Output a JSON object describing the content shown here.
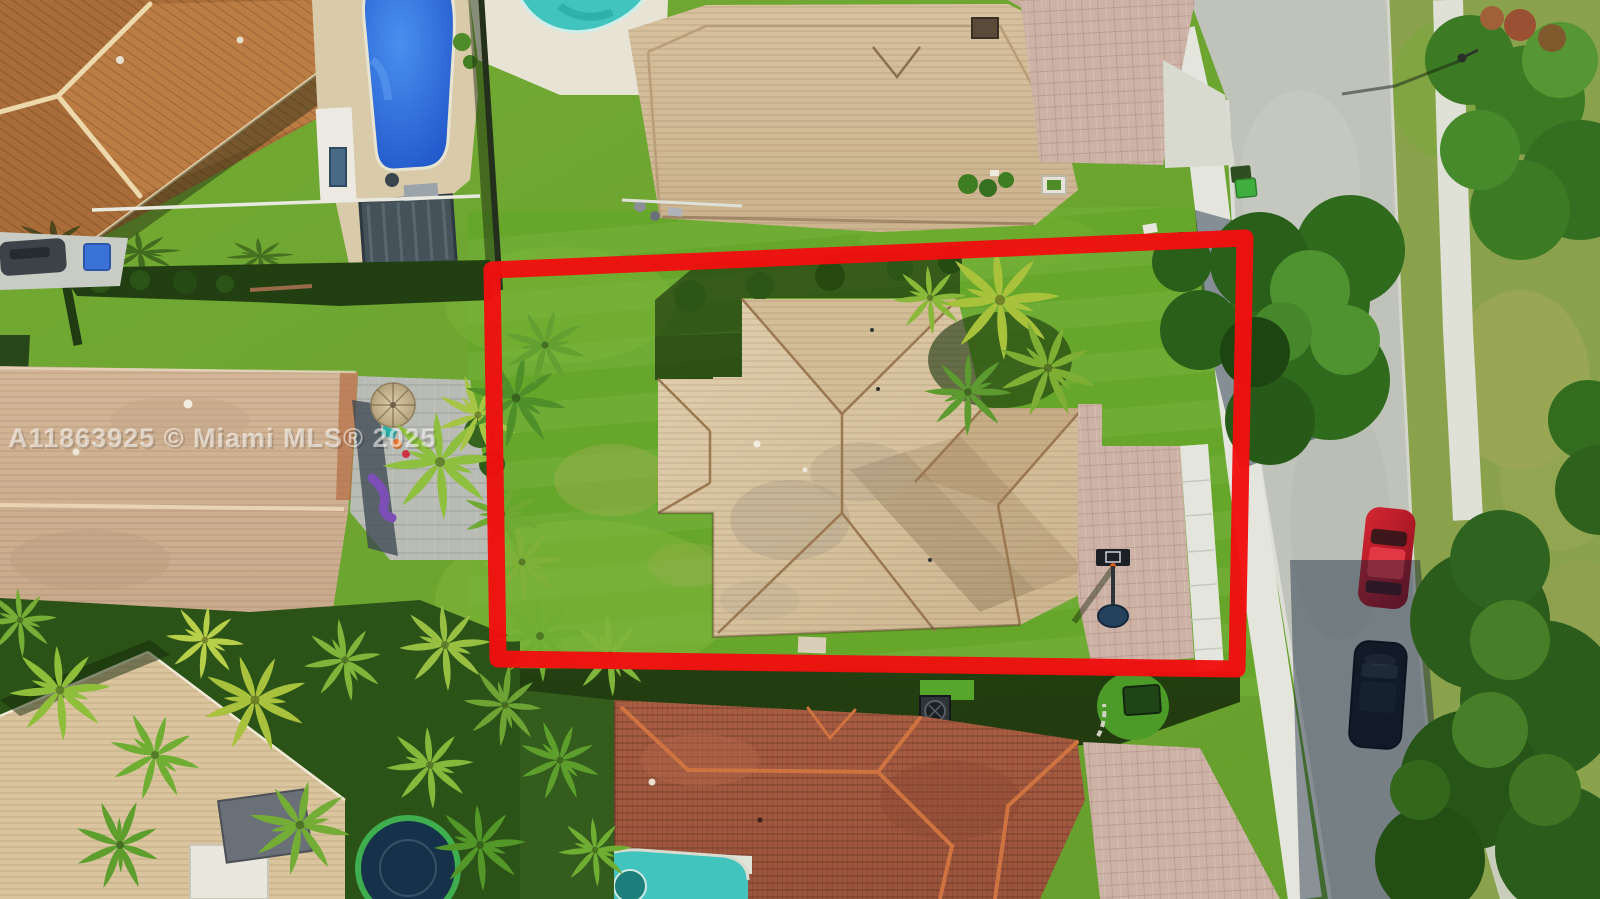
{
  "watermark": {
    "text": "A11863925 © Miami MLS® 2025"
  },
  "palette": {
    "red_outline": "#ef1010",
    "watermark_color": "#ffffff",
    "lawn_subject": "#66a72b",
    "grass_base": "#6da52f",
    "grass_dry": "#8ba24c",
    "street": "#bfc3ba",
    "sidewalk": "#e4e6dd",
    "driveway_pavers": "#cdb2a6",
    "roof_subject": "#d8c4a2",
    "roof_north": "#d2bc99",
    "roof_west": "#cfb293",
    "roof_south": "#a35a40",
    "roof_northwest": "#a86d38",
    "pool_blue": "#2f7fe0",
    "pool_teal": "#41c4bd",
    "tree_dark": "#2f6a1d",
    "palm_green": "#8fbe3a",
    "trash_bin_green": "#3fae3f",
    "car_red": "#c01c28",
    "car_black": "#14181d"
  },
  "scene": {
    "type": "aerial-property-photo",
    "subject": "single-family home outlined in red",
    "objects": [
      "red-property-boundary",
      "subject-house-roof",
      "subject-driveway",
      "basketball-hoop",
      "street",
      "sidewalk",
      "red-car",
      "black-car",
      "trash-bins",
      "manhole",
      "north-house",
      "northwest-house",
      "west-house",
      "south-house",
      "southwest-house",
      "blue-pool",
      "teal-pool-north",
      "teal-pool-south",
      "pergola",
      "patio-umbrella",
      "trampoline",
      "palm-trees",
      "street-trees",
      "hedges",
      "ac-unit",
      "utility-box",
      "lamp-post"
    ]
  }
}
